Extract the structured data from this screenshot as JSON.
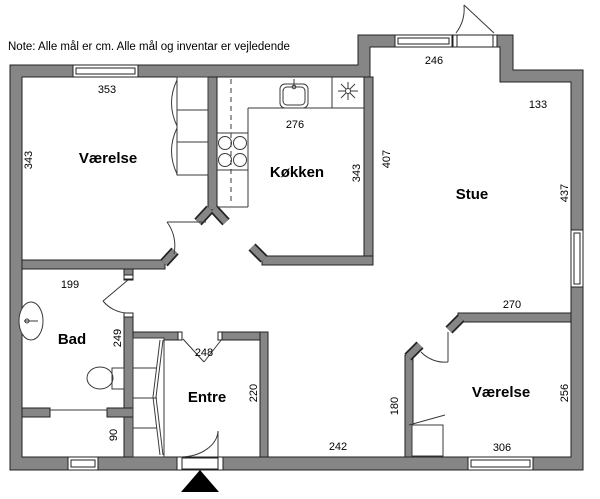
{
  "note": {
    "text": "Note: Alle mål er cm. Alle mål og inventar er vejledende"
  },
  "colors": {
    "wall_fill": "#868686",
    "wall_stroke": "#222222",
    "thin_line": "#3a3a3a",
    "background": "#ffffff",
    "entrance_marker": "#000000"
  },
  "rooms": {
    "vaerelse_nw": {
      "label": "Værelse"
    },
    "koekken": {
      "label": "Køkken"
    },
    "stue": {
      "label": "Stue"
    },
    "bad": {
      "label": "Bad"
    },
    "entre": {
      "label": "Entre"
    },
    "vaerelse_se": {
      "label": "Værelse"
    }
  },
  "dimensions_cm": {
    "vaerelse_nw_top": "353",
    "vaerelse_nw_left": "343",
    "koekken_top": "276",
    "koekken_right": "343",
    "stue_left": "407",
    "stue_top": "246",
    "stue_notch": "133",
    "stue_right": "437",
    "stue_bottom": "270",
    "vaerelse_se_right": "256",
    "vaerelse_se_bottom": "306",
    "vaerelse_se_left": "180",
    "hall_bottom": "242",
    "entre_top": "248",
    "entre_right": "220",
    "bad_top": "199",
    "bad_right": "249",
    "utility_right": "90"
  },
  "fixtures": {
    "kitchen_sink": "kitchen-sink",
    "stove": "stove-four-burners",
    "light_symbol": "light-asterisk",
    "bath_sink": "hand-basin",
    "toilet": "toilet",
    "wardrobe_nw": "wardrobe",
    "wardrobe_entre": "wardrobe",
    "wardrobe_se": "wardrobe",
    "entrance_marker": "entrance-arrow"
  }
}
